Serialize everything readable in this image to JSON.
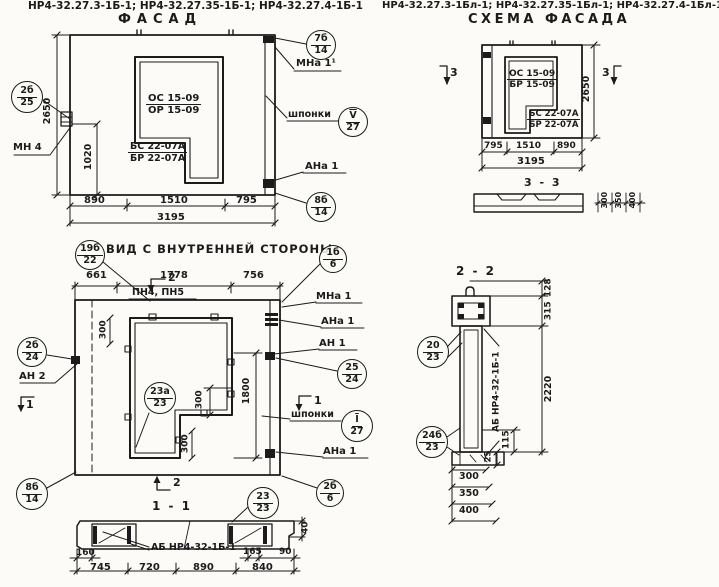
{
  "headers": {
    "left": "НР4-32.27.3-1Б-1; НР4-32.27.35-1Б-1; НР4-32.27.4-1Б-1",
    "right": "НР4-32.27.3-1Бл-1; НР4-32.27.35-1Бл-1; НР4-32.27.4-1Бл-1"
  },
  "facade": {
    "title": "ФАСАД",
    "panel": {
      "os": "ОС 15-09",
      "or": "ОР 15-09",
      "bs": "БС 22-07А",
      "br": "БР 22-07А"
    },
    "anchors": {
      "mn4": "МН 4",
      "mna1": "МНа 1¹",
      "shponki": "шпонки",
      "ana1": "АНа 1"
    },
    "callouts": {
      "c2b": {
        "t": "2б",
        "b": "25"
      },
      "c7b": {
        "t": "7б",
        "b": "14"
      },
      "cV": {
        "t": "V",
        "b": "27"
      },
      "c8b": {
        "t": "8б",
        "b": "14"
      }
    },
    "dims": {
      "h": "2650",
      "v": "1020",
      "a": "890",
      "b": "1510",
      "c": "795",
      "total": "3195"
    }
  },
  "schema": {
    "title": "СХЕМА ФАСАДА",
    "sec": "3",
    "panel": {
      "os": "ОС 15-09",
      "br1": "БР 15-09",
      "bs": "БС 22-07А",
      "br2": "БР 22-07А"
    },
    "dims": {
      "h": "2650",
      "a": "795",
      "b": "1510",
      "c": "890",
      "total": "3195"
    },
    "cut": {
      "title": "3 - 3",
      "dims": [
        "300",
        "350",
        "400"
      ]
    }
  },
  "inner": {
    "title": "ВИД С ВНУТРЕННЕЙ СТОРОНЫ",
    "top": {
      "a": "661",
      "b": "1778",
      "c": "756",
      "pn": "ПН4, ПН5"
    },
    "sec1": "1",
    "sec2": "2",
    "right": {
      "mna1": "МНа 1",
      "ana1": "АНа 1",
      "an1": "АН 1",
      "shponki": "шпонки",
      "ana1b": "АНа 1"
    },
    "left": {
      "an2": "АН 2"
    },
    "callouts": {
      "c19": {
        "t": "19б",
        "b": "22"
      },
      "c1b": {
        "t": "1б",
        "b": "6"
      },
      "c2b24": {
        "t": "2б",
        "b": "24"
      },
      "c25": {
        "t": "25",
        "b": "24"
      },
      "cI": {
        "t": "I",
        "b": "27"
      },
      "c2b6": {
        "t": "2б",
        "b": "6"
      },
      "c8b": {
        "t": "8б",
        "b": "14"
      },
      "c23a": {
        "t": "23а",
        "b": "23"
      }
    },
    "dims": {
      "d300": "300",
      "d1800": "1800"
    }
  },
  "s11": {
    "title": "1 - 1",
    "label": "АБ НР4-32-1Б-1",
    "callout": {
      "t": "23",
      "b": "23"
    },
    "dims": {
      "a": "160",
      "b": "745",
      "c": "720",
      "d": "890",
      "e": "165",
      "f": "840",
      "g": "90",
      "h": "40"
    }
  },
  "s22": {
    "title": "2 - 2",
    "label": "АБ НР4-32-1Б-1",
    "callouts": {
      "c20": {
        "t": "20",
        "b": "23"
      },
      "c24": {
        "t": "24б",
        "b": "23"
      }
    },
    "dims": {
      "a": "128",
      "b": "315",
      "c": "2220",
      "d": "115",
      "e": "25",
      "f": "300",
      "g": "350",
      "h": "400"
    }
  }
}
